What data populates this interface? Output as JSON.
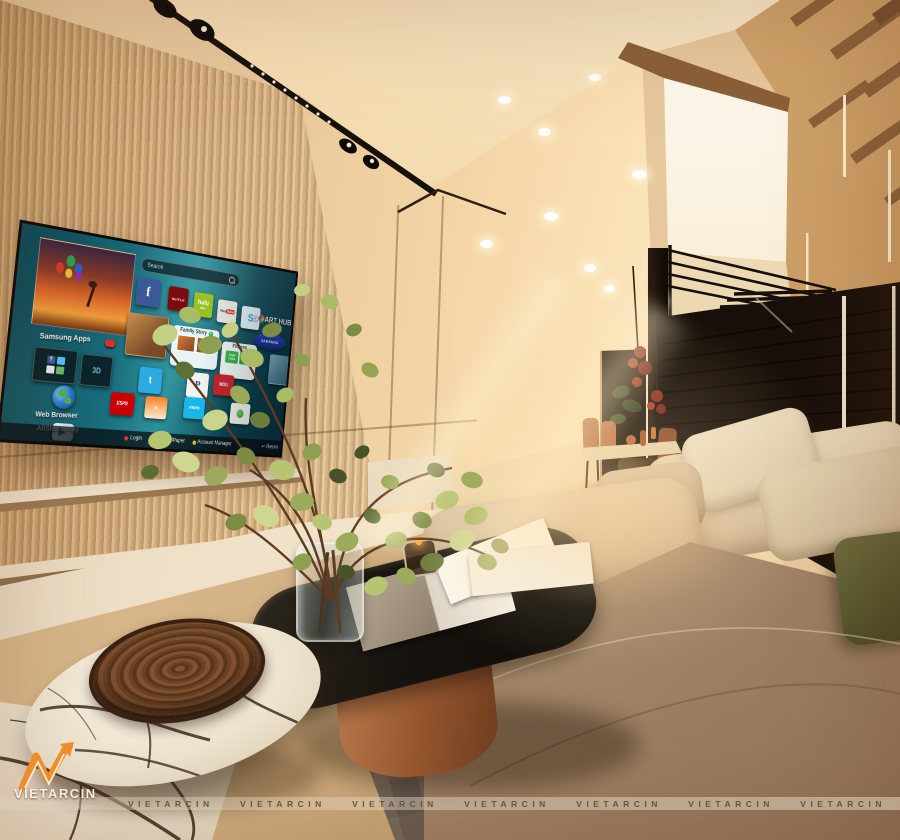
{
  "tv": {
    "search_label": "Search",
    "samsung_apps": "Samsung Apps",
    "explore_glyph": "3D",
    "explore_3d": "Explore 3D",
    "web_browser": "Web Browser",
    "allshare_play": "AllShare Play",
    "smart_hub_s": "S",
    "smart_hub_rest": "ART HUB",
    "samsung_wordmark": "SAMSUNG",
    "family_story": "Family Story",
    "fitness": "Fitness",
    "yoga1": "YOUR YOGA",
    "yoga2": "YOUR YOGA",
    "fb_letter": "f",
    "netflix_word": "NETFLIX",
    "hulu_word": "hulu",
    "hulu_plus_word": "plus",
    "youtube_you": "You",
    "youtube_tube": "Tube",
    "skype_letter": "S",
    "twitter_letter": "t",
    "pandora_letter": "P",
    "mog_word": "MOG",
    "espn_word": "ESPN",
    "vimeo_word": "vimeo",
    "labels": {
      "netflix": "Netflix",
      "hulu": "Hulu Plus",
      "youtube": "YouTube",
      "skype": "Skype",
      "your_video": "Your Video",
      "twitter": "Twitter",
      "pandora": "Pandora",
      "mog": "MOG Music",
      "espn": "ESPN ScoreCenter",
      "accuweather": "AccuWeather",
      "vimeo": "Vimeo",
      "sns": "Samsung SNS"
    },
    "bottom": {
      "login": "Login",
      "wallpaper": "WallPaper",
      "account": "Account Manager",
      "return_label": "Return"
    },
    "icons": {
      "accuweather_sun": "☀",
      "return_arrow": "↩"
    }
  },
  "watermark": {
    "strip": [
      "VIETARCIN",
      "VIETARCIN",
      "VIETARCIN",
      "VIETARCIN",
      "VIETARCIN",
      "VIETARCIN",
      "VIETARCIN"
    ],
    "logo_brand": "VIETARCIN",
    "logo_subtitle": "ARCHITECTURE INTERIOR"
  },
  "colors": {
    "accent_orange": "#e8892f",
    "tv_teal": "#0f6172",
    "sofa_beige": "#c9ae8c",
    "copper": "#a05a33",
    "olive_pillow": "#5c5c34",
    "ceiling_cream": "#f6e3c4"
  }
}
